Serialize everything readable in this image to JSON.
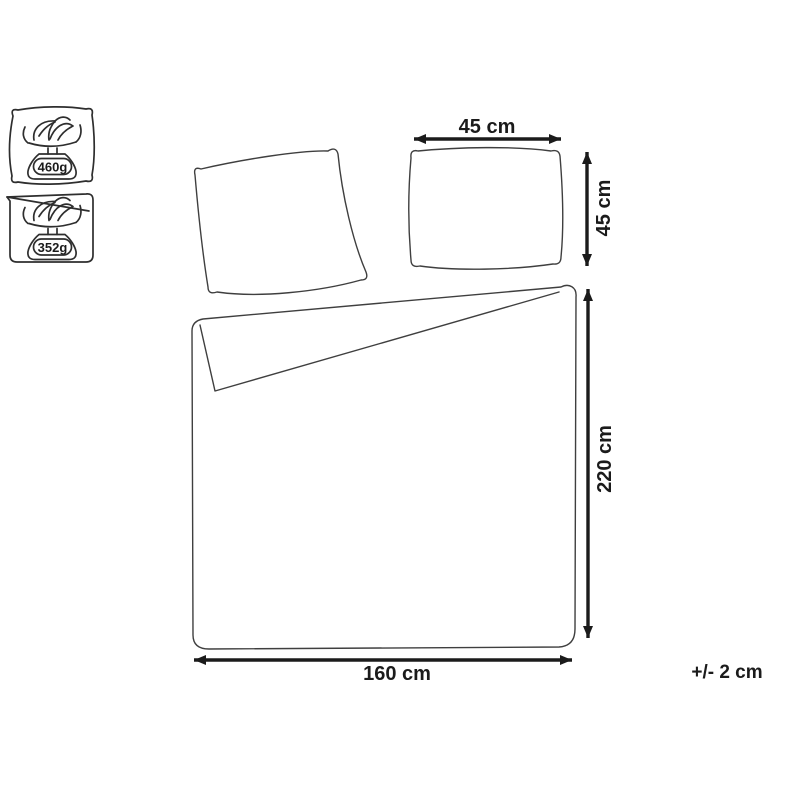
{
  "diagram": {
    "weight_icons": [
      {
        "item": "pillow",
        "weight": "460g"
      },
      {
        "item": "duvet",
        "weight": "352g"
      }
    ],
    "dimensions": {
      "pillow_width": "45 cm",
      "pillow_height": "45 cm",
      "duvet_height": "220 cm",
      "duvet_width": "160 cm"
    },
    "tolerance": "+/- 2 cm",
    "colors": {
      "line": "#3f3f3f",
      "dimension": "#1b1b1b",
      "background": "#ffffff"
    }
  }
}
